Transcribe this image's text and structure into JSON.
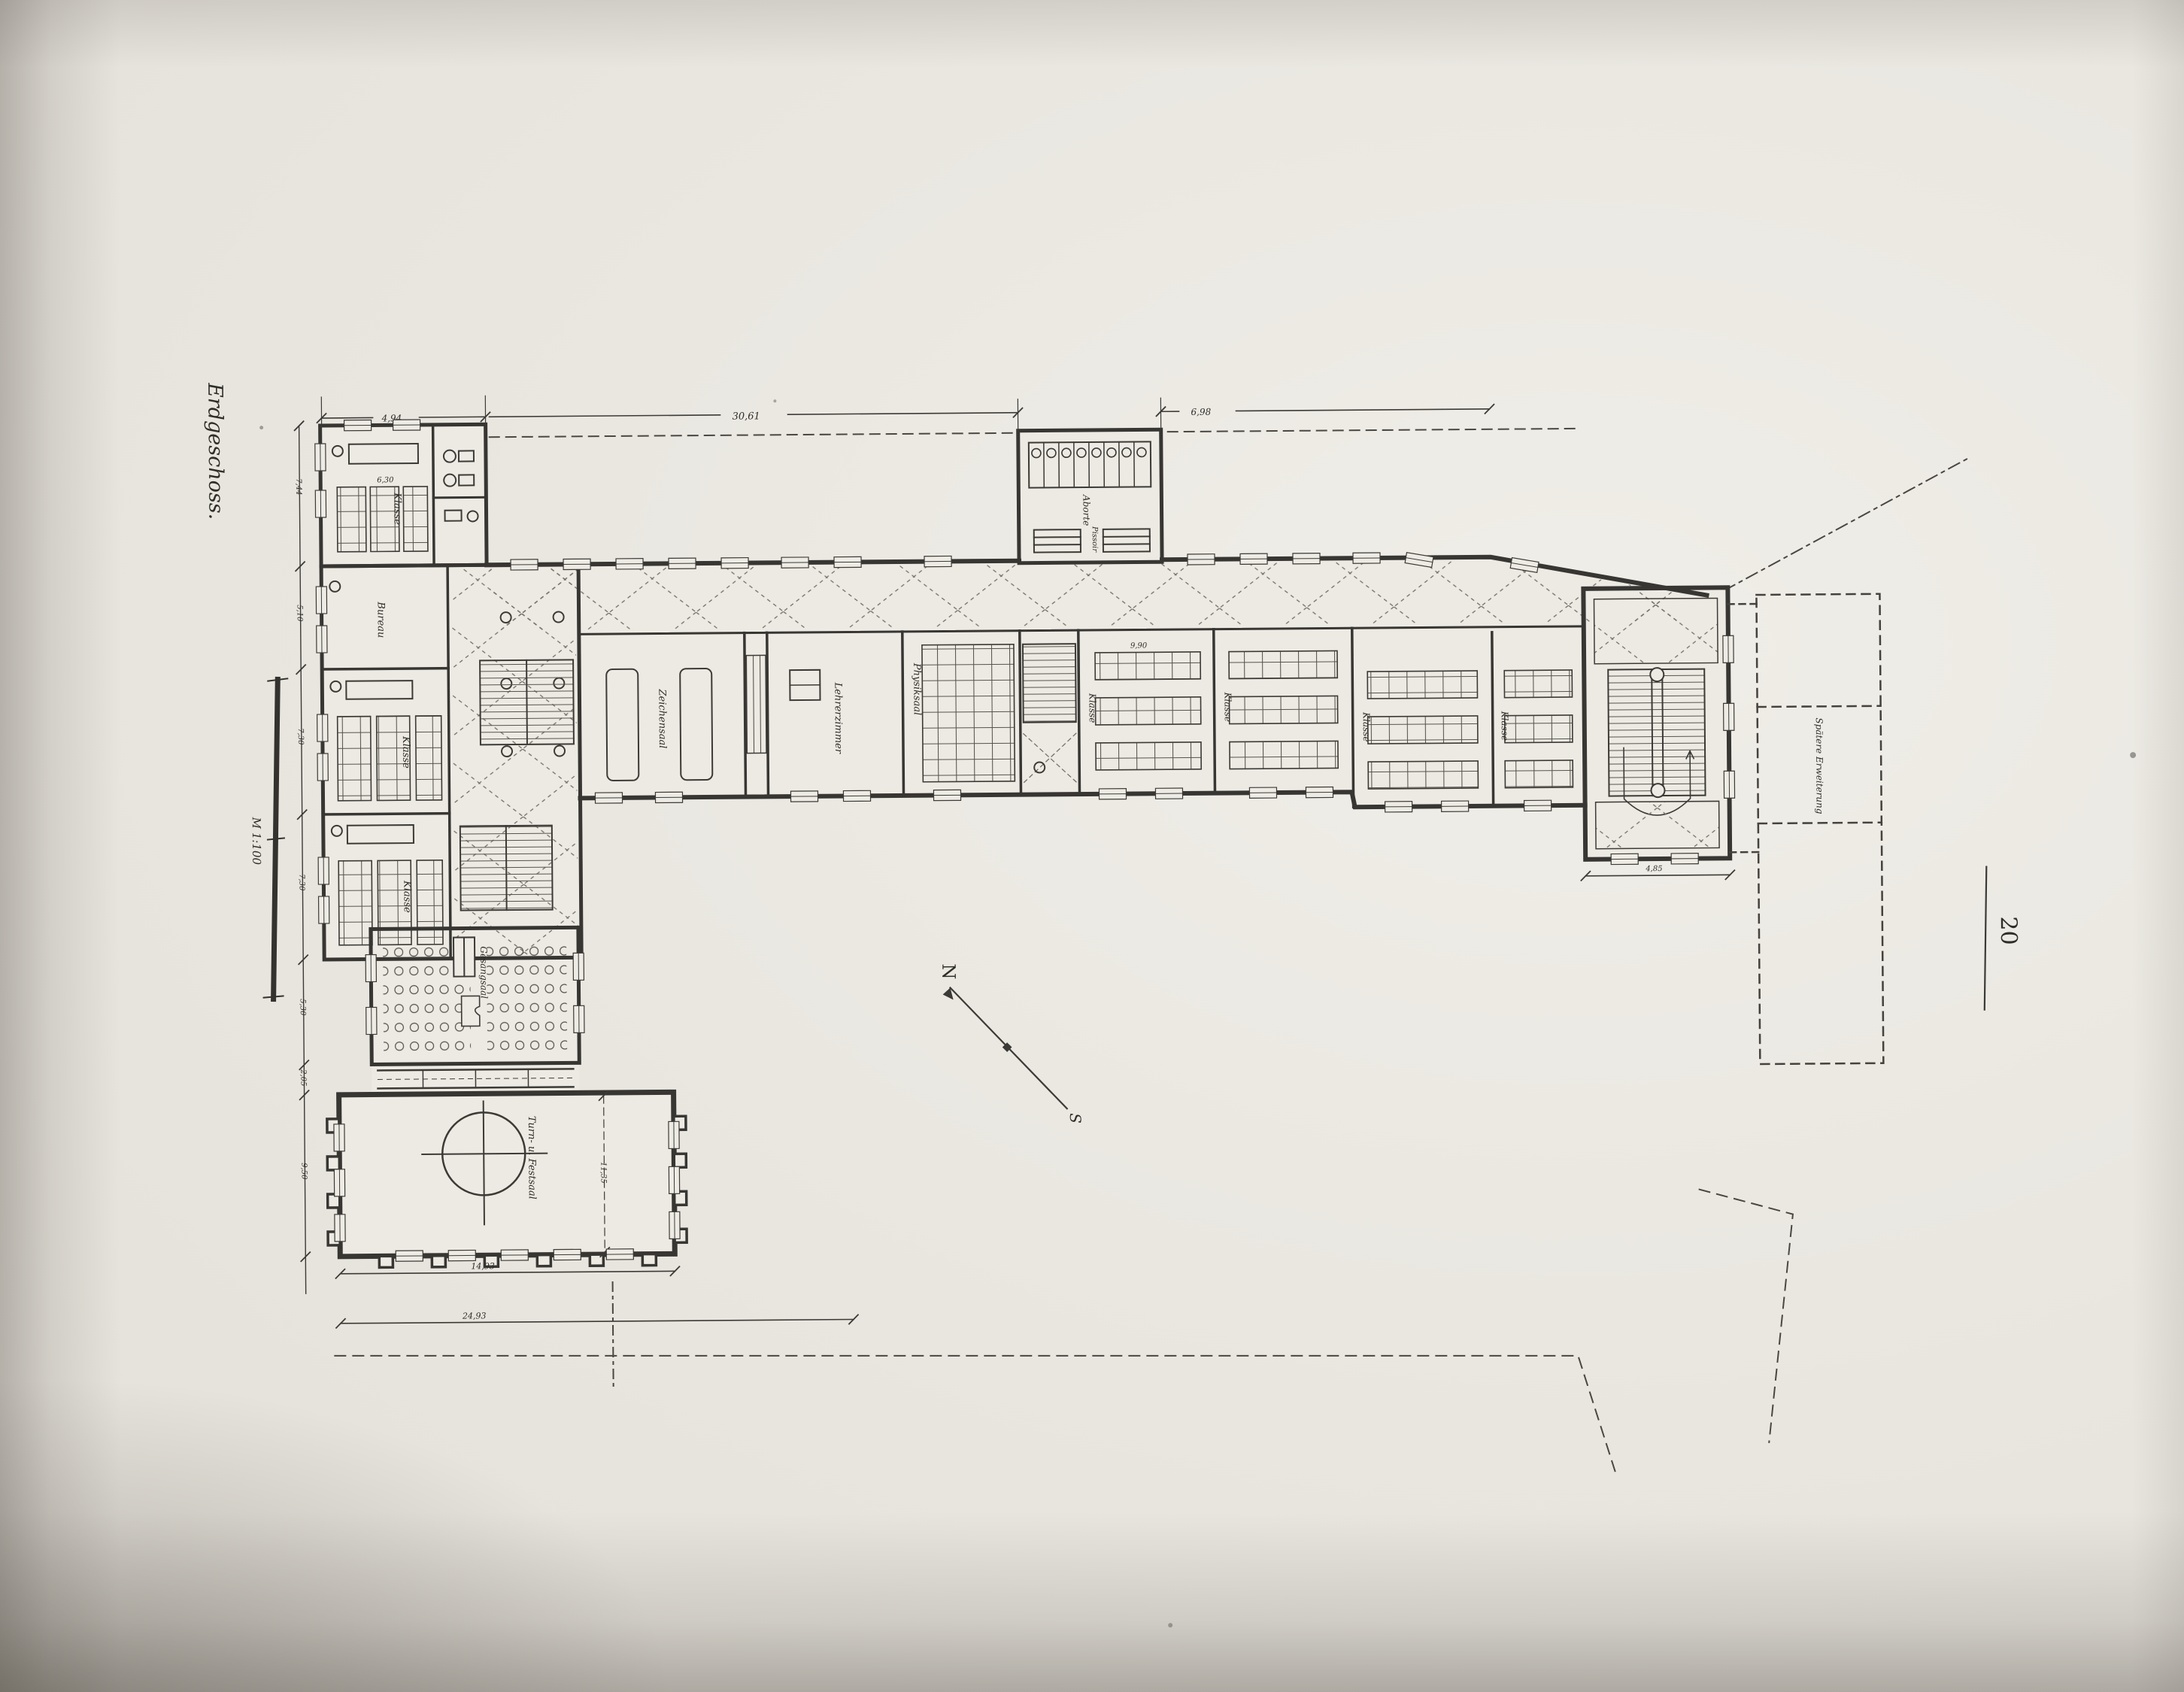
{
  "page": {
    "floor_label": "Erdgeschoss.",
    "page_number": "20",
    "scale_label": "M 1:100",
    "compass_north": "N",
    "compass_south": "S"
  },
  "rooms": {
    "classroom_top_left": "Klasse",
    "bureau": "Bureau",
    "classroom_west_1": "Klasse",
    "classroom_west_2": "Klasse",
    "drawing_hall": "Zeichensaal",
    "teachers_room": "Lehrerzimmer",
    "physics_hall": "Physiksaal",
    "classroom_east_1": "Klasse",
    "classroom_east_2": "Klasse",
    "classroom_east_3": "Klasse",
    "classroom_east_4": "Klasse",
    "boys_toilets": "Aborte",
    "urinals": "Pissoir",
    "singing_hall": "Gesangsaal",
    "gym_festival_hall": "Turn- u. Festsaal",
    "future_extension": "Spätere Erweiterung"
  },
  "dimensions": {
    "top_left_width": "4,94",
    "main_wing_length": "30,61",
    "annex_width": "6,98",
    "classroom_width": "9,90",
    "classroom_depth": "6,30",
    "hall_width": "14,93",
    "hall_site_width": "24,93",
    "tower_width": "4,85",
    "hall_depth": "11,35",
    "side": [
      "7,44",
      "5,10",
      "7,30",
      "7,30",
      "5,30",
      "2,05",
      "9,50"
    ]
  }
}
